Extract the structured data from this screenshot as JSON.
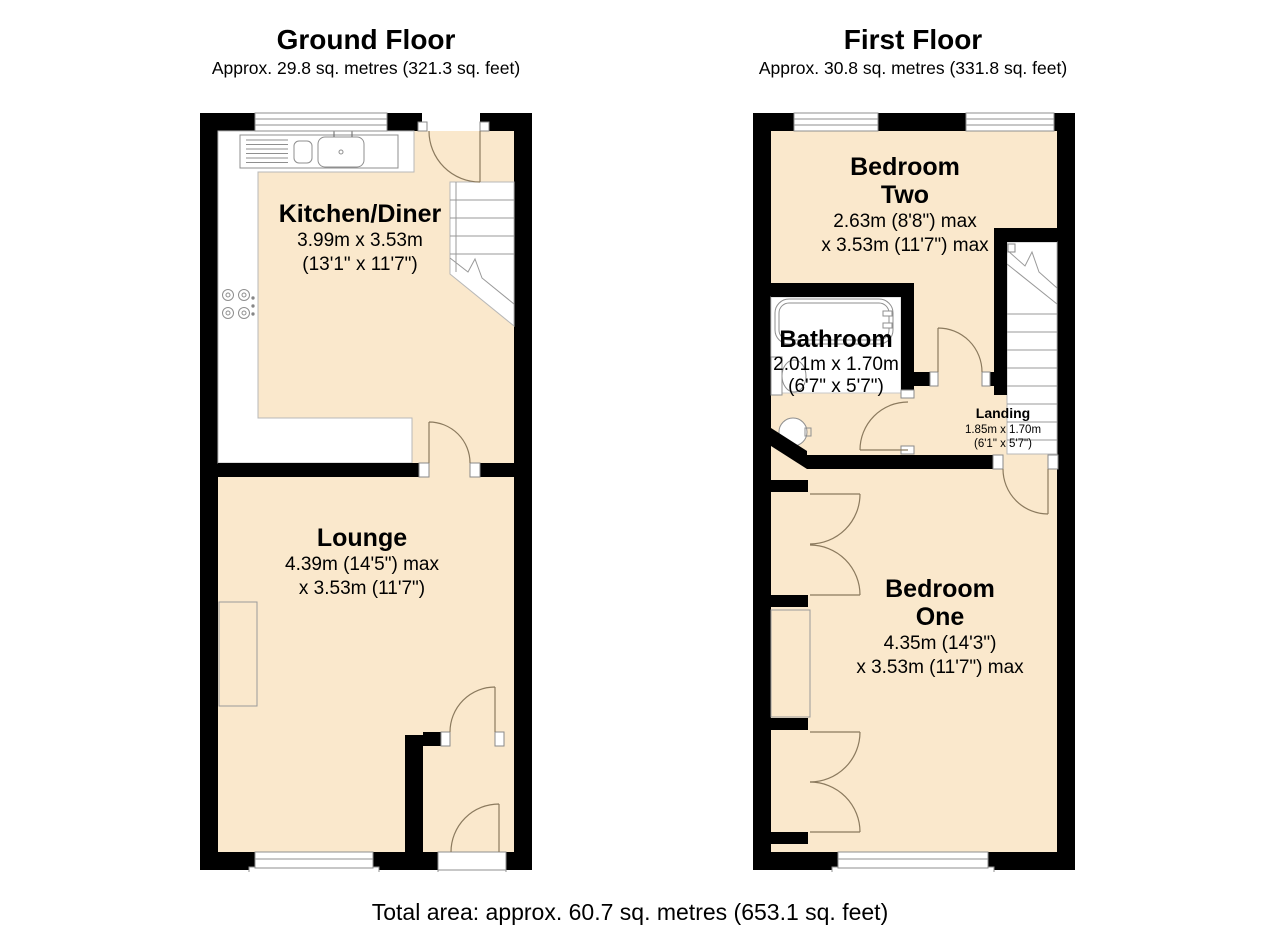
{
  "colors": {
    "floor_fill": "#FAE8CC",
    "wall": "#000000",
    "door_arc": "#8B7A5E"
  },
  "ground_floor": {
    "title": "Ground Floor",
    "subtitle": "Approx. 29.8 sq. metres (321.3 sq. feet)",
    "rooms": {
      "kitchen": {
        "name": "Kitchen/Diner",
        "dims_line1": "3.99m x 3.53m",
        "dims_line2": "(13'1\" x 11'7\")"
      },
      "lounge": {
        "name": "Lounge",
        "dims_line1": "4.39m (14'5\") max",
        "dims_line2": "x 3.53m (11'7\")"
      }
    }
  },
  "first_floor": {
    "title": "First Floor",
    "subtitle": "Approx. 30.8 sq. metres (331.8 sq. feet)",
    "rooms": {
      "bedroom_two": {
        "name_line1": "Bedroom",
        "name_line2": "Two",
        "dims_line1": "2.63m (8'8\") max",
        "dims_line2": "x 3.53m (11'7\") max"
      },
      "bathroom": {
        "name": "Bathroom",
        "dims_line1": "2.01m x 1.70m",
        "dims_line2": "(6'7\" x 5'7\")"
      },
      "landing": {
        "name": "Landing",
        "dims_line1": "1.85m x 1.70m",
        "dims_line2": "(6'1\" x 5'7\")"
      },
      "bedroom_one": {
        "name_line1": "Bedroom",
        "name_line2": "One",
        "dims_line1": "4.35m (14'3\")",
        "dims_line2": "x 3.53m (11'7\") max"
      }
    }
  },
  "footer": {
    "total_area": "Total area: approx. 60.7 sq. metres (653.1 sq. feet)"
  }
}
